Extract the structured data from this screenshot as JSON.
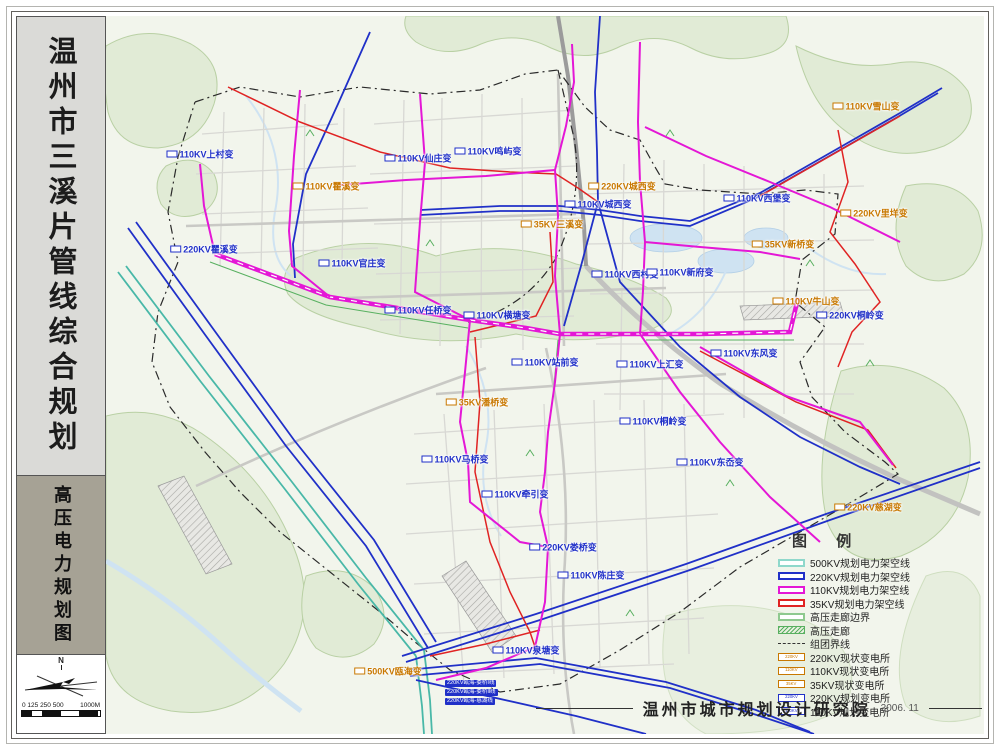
{
  "colors": {
    "kv500": "#49b8a8",
    "kv220": "#2030c8",
    "kv110": "#e417d6",
    "kv35": "#e02323",
    "corridor": "#58b060",
    "boundary": "#2a2a2a",
    "existing_station": "#c87800",
    "planned_station": "#2030c8",
    "map_bg": "#f2f5ec",
    "terrain": "#e1ebd6",
    "water": "#cfe3f2"
  },
  "sidebar": {
    "title": "温州市三溪片管线综合规划",
    "subtitle": "高压电力规划图",
    "north_label": "N",
    "scale_ticks": "0 125 250 500",
    "scale_end": "1000M"
  },
  "map": {
    "stations": [
      {
        "label": "110KV上村变",
        "x": 94,
        "y": 138,
        "color": "#2030c8"
      },
      {
        "label": "110KV仙庄变",
        "x": 312,
        "y": 142,
        "color": "#2030c8"
      },
      {
        "label": "110KV瞿溪变",
        "x": 220,
        "y": 170,
        "color": "#c87800"
      },
      {
        "label": "220KV瞿溪变",
        "x": 98,
        "y": 233,
        "color": "#2030c8"
      },
      {
        "label": "110KV官庄变",
        "x": 246,
        "y": 247,
        "color": "#2030c8"
      },
      {
        "label": "110KV鸣屿变",
        "x": 382,
        "y": 135,
        "color": "#2030c8"
      },
      {
        "label": "220KV城西变",
        "x": 516,
        "y": 170,
        "color": "#c87800"
      },
      {
        "label": "110KV城西变",
        "x": 492,
        "y": 188,
        "color": "#2030c8"
      },
      {
        "label": "35KV三溪变",
        "x": 446,
        "y": 208,
        "color": "#c87800"
      },
      {
        "label": "110KV西村变",
        "x": 519,
        "y": 258,
        "color": "#2030c8"
      },
      {
        "label": "110KV新府变",
        "x": 574,
        "y": 256,
        "color": "#2030c8"
      },
      {
        "label": "110KV任桥变",
        "x": 312,
        "y": 294,
        "color": "#2030c8"
      },
      {
        "label": "110KV横塘变",
        "x": 391,
        "y": 299,
        "color": "#2030c8"
      },
      {
        "label": "110KV站前变",
        "x": 439,
        "y": 346,
        "color": "#2030c8"
      },
      {
        "label": "110KV上汇变",
        "x": 544,
        "y": 348,
        "color": "#2030c8"
      },
      {
        "label": "35KV潘桥变",
        "x": 371,
        "y": 386,
        "color": "#c87800"
      },
      {
        "label": "110KV桐岭变",
        "x": 547,
        "y": 405,
        "color": "#2030c8"
      },
      {
        "label": "110KV马桥变",
        "x": 349,
        "y": 443,
        "color": "#2030c8"
      },
      {
        "label": "110KV东岙变",
        "x": 604,
        "y": 446,
        "color": "#2030c8"
      },
      {
        "label": "110KV牵引变",
        "x": 409,
        "y": 478,
        "color": "#2030c8"
      },
      {
        "label": "220KV娄桥变",
        "x": 457,
        "y": 531,
        "color": "#2030c8"
      },
      {
        "label": "110KV陈庄变",
        "x": 485,
        "y": 559,
        "color": "#2030c8"
      },
      {
        "label": "110KV泉塘变",
        "x": 420,
        "y": 634,
        "color": "#2030c8"
      },
      {
        "label": "500KV瓯海变",
        "x": 282,
        "y": 655,
        "color": "#c87800"
      },
      {
        "label": "110KV雪山变",
        "x": 760,
        "y": 90,
        "color": "#c87800"
      },
      {
        "label": "110KV西堡变",
        "x": 651,
        "y": 182,
        "color": "#2030c8"
      },
      {
        "label": "220KV里垟变",
        "x": 768,
        "y": 197,
        "color": "#c87800"
      },
      {
        "label": "35KV新桥变",
        "x": 677,
        "y": 228,
        "color": "#c87800"
      },
      {
        "label": "110KV牛山变",
        "x": 700,
        "y": 285,
        "color": "#c87800"
      },
      {
        "label": "220KV桐岭变",
        "x": 744,
        "y": 299,
        "color": "#2030c8"
      },
      {
        "label": "110KV东风变",
        "x": 638,
        "y": 337,
        "color": "#2030c8"
      },
      {
        "label": "220KV慈湖变",
        "x": 762,
        "y": 491,
        "color": "#c87800"
      }
    ],
    "line_labels": [
      {
        "label": "220KV瓯海-娄桥Ⅰ线",
        "x": 339,
        "y": 664
      },
      {
        "label": "220KV瓯海-娄桥Ⅱ线",
        "x": 339,
        "y": 673
      },
      {
        "label": "220KV瓯海-慈湖线",
        "x": 339,
        "y": 682
      }
    ],
    "legend": {
      "title": "图 例",
      "items": [
        {
          "type": "line",
          "swatch_color": "#8fd8cb",
          "label": "500KV规划电力架空线"
        },
        {
          "type": "line",
          "swatch_color": "#2030c8",
          "label": "220KV规划电力架空线"
        },
        {
          "type": "line",
          "swatch_color": "#e417d6",
          "label": "110KV规划电力架空线"
        },
        {
          "type": "line",
          "swatch_color": "#e02323",
          "label": "35KV规划电力架空线"
        },
        {
          "type": "line",
          "swatch_color": "#8fc98f",
          "label": "高压走廊边界"
        },
        {
          "type": "corridor",
          "swatch_color": "#58b060",
          "label": "高压走廊"
        },
        {
          "type": "dashdot",
          "swatch_color": "#333333",
          "label": "组团界线"
        },
        {
          "type": "station",
          "swatch_color": "#c87800",
          "tag": "220KV",
          "label": "220KV现状变电所"
        },
        {
          "type": "station",
          "swatch_color": "#c87800",
          "tag": "110KV",
          "label": "110KV现状变电所"
        },
        {
          "type": "station",
          "swatch_color": "#c87800",
          "tag": "35KV",
          "label": "35KV现状变电所"
        },
        {
          "type": "station",
          "swatch_color": "#2030c8",
          "tag": "220KV",
          "label": "220KV规划变电所"
        },
        {
          "type": "station",
          "swatch_color": "#2030c8",
          "tag": "110KV",
          "label": "110KV规划变电所"
        }
      ]
    },
    "attribution": {
      "org": "温州市城市规划设计研究院",
      "date": "2006. 11"
    }
  }
}
